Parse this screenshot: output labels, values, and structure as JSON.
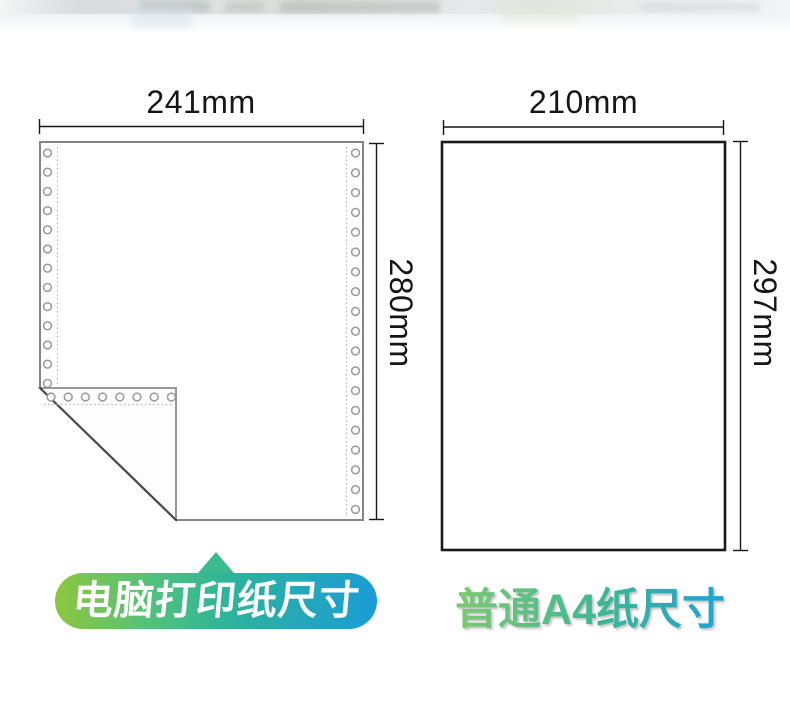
{
  "left_figure": {
    "width_label": "241mm",
    "height_label": "280mm",
    "caption": "电脑打印纸尺寸"
  },
  "right_figure": {
    "width_label": "210mm",
    "height_label": "297mm",
    "caption": "普通A4纸尺寸"
  },
  "colors": {
    "badge_gradient_start": "#8dc63f",
    "badge_gradient_end": "#1b9cd8",
    "badge_pointer": "#3abb8e",
    "caption_gradient_start": "#83ca6f",
    "caption_gradient_end": "#1e9fdd",
    "dimension_line": "#161616",
    "printer_paper_border": "#858585",
    "a4_border": "#1b1b1b",
    "hole_outline": "#999999"
  }
}
